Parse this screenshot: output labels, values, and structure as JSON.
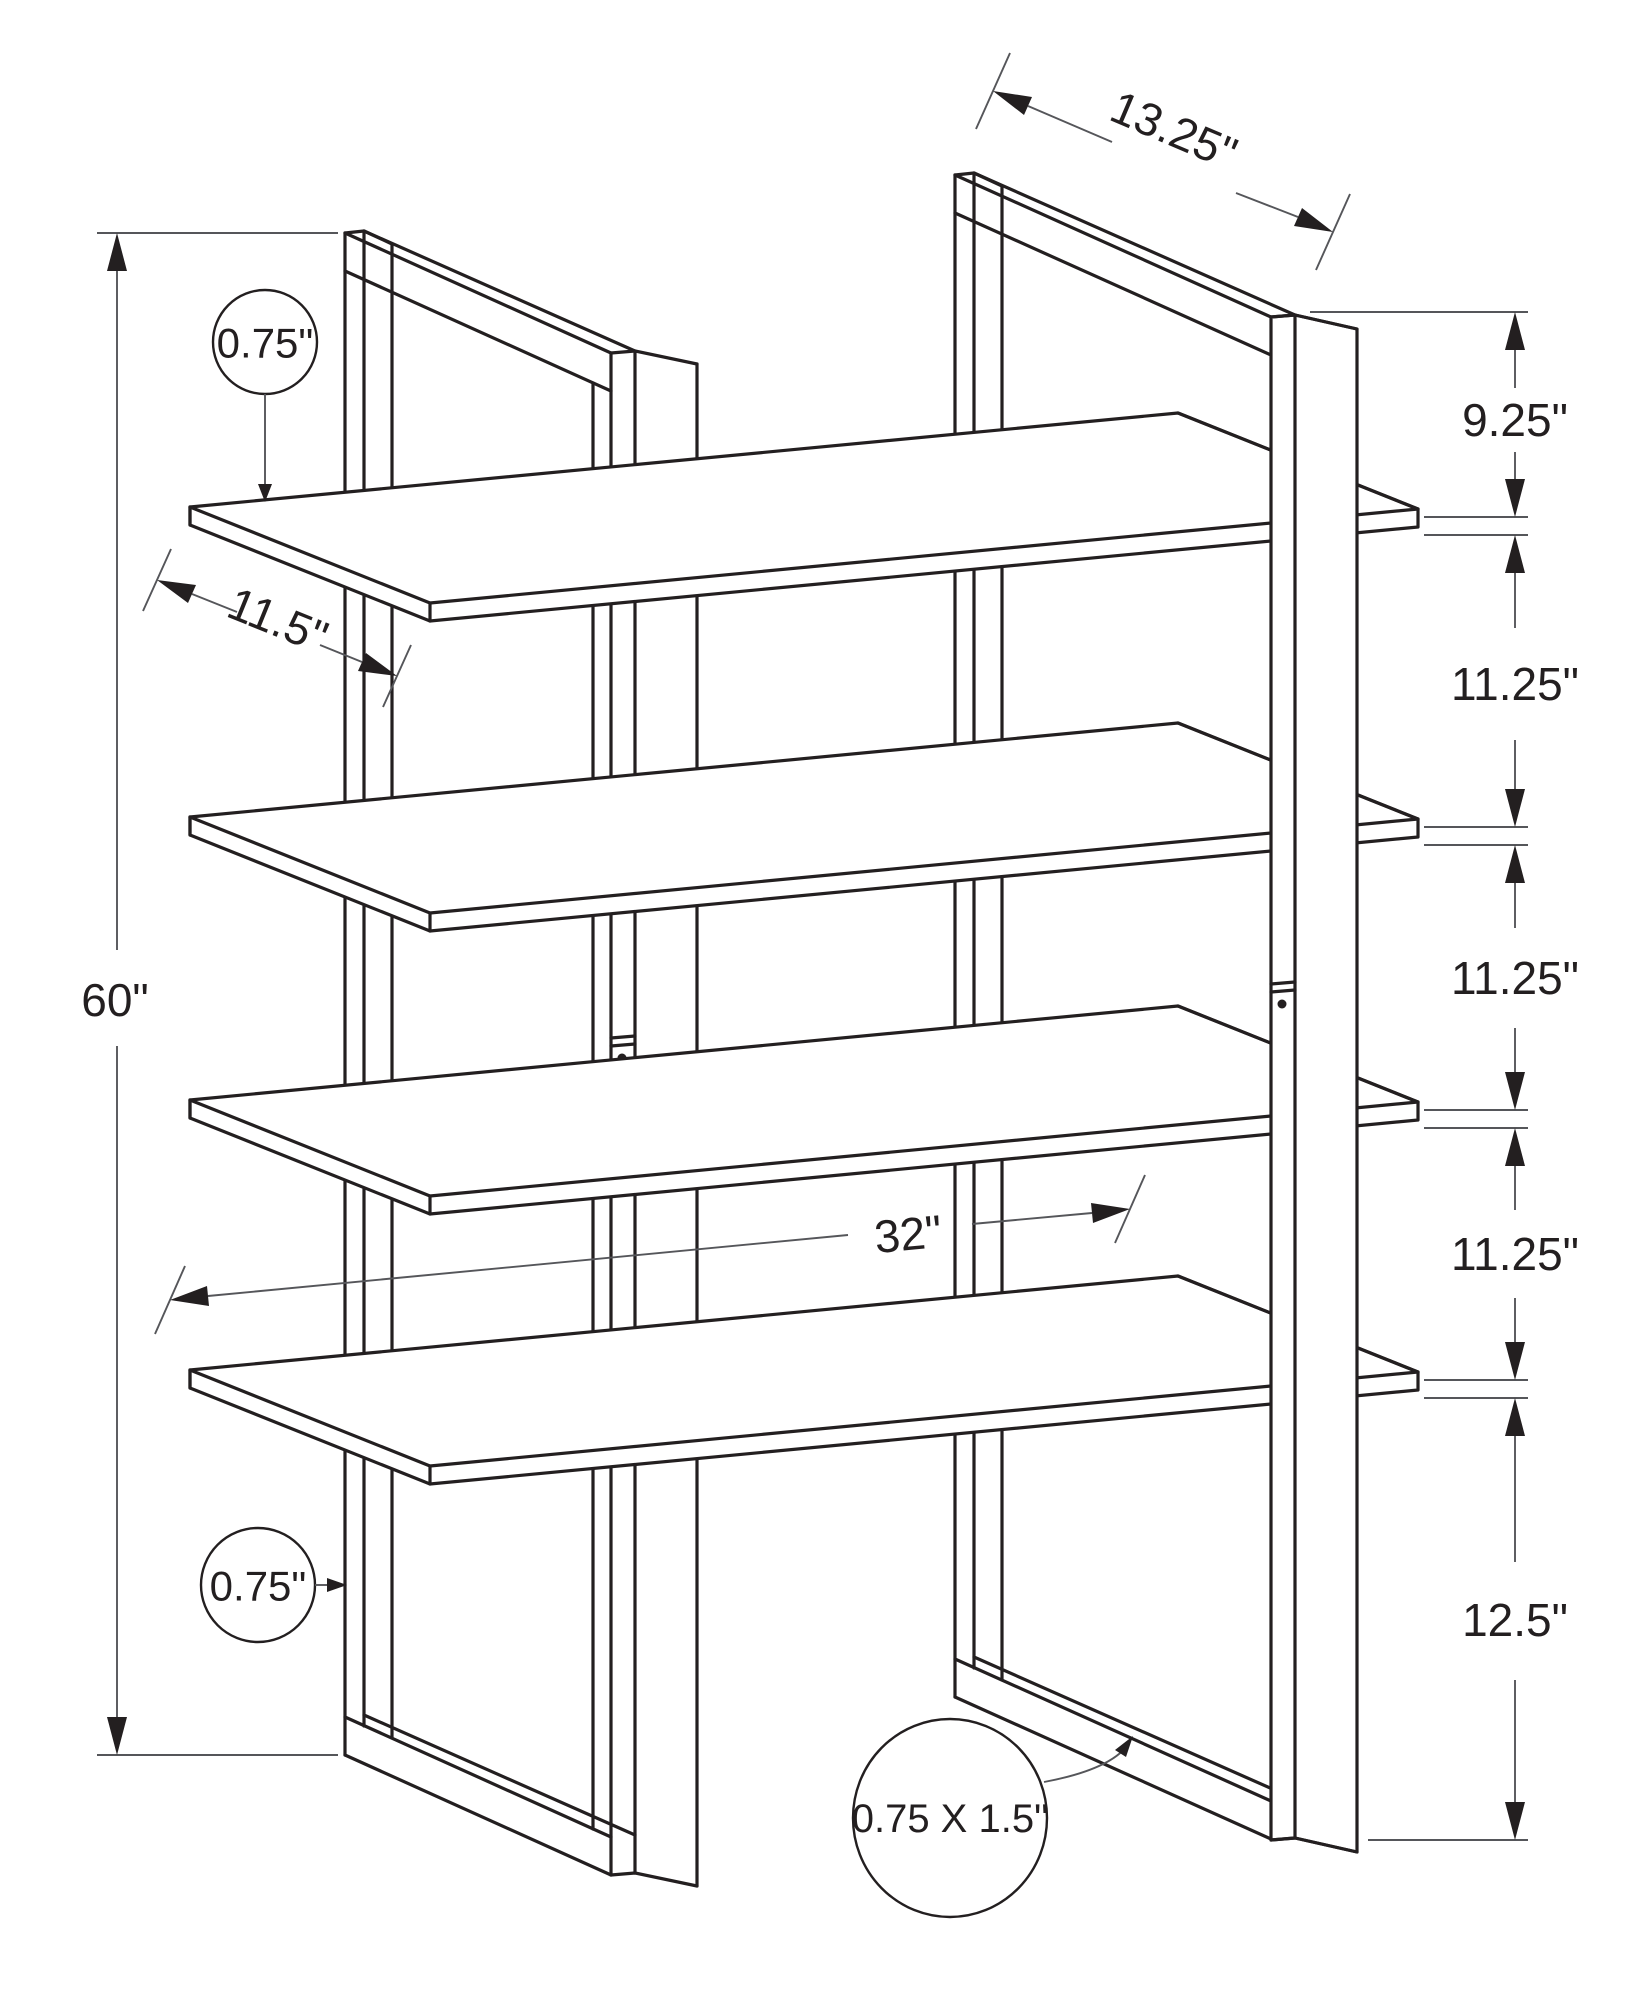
{
  "drawing": {
    "type": "isometric furniture dimension drawing",
    "subject": "4-shelf ladder bookcase with two metal frames",
    "background_color": "#ffffff",
    "line_color": "#231f20",
    "dim_line_color": "#55565a"
  },
  "dims": {
    "depth_top": "13.25\"",
    "spacing_top": "9.25\"",
    "spacing_mid1": "11.25\"",
    "spacing_mid2": "11.25\"",
    "spacing_mid3": "11.25\"",
    "spacing_bottom": "12.5\"",
    "total_height": "60\"",
    "shelf_depth": "11.5\"",
    "shelf_width": "32\"",
    "callout_shelf_thickness": "0.75\"",
    "callout_frame_width": "0.75\"",
    "callout_frame_section": "0.75 X 1.5\""
  }
}
